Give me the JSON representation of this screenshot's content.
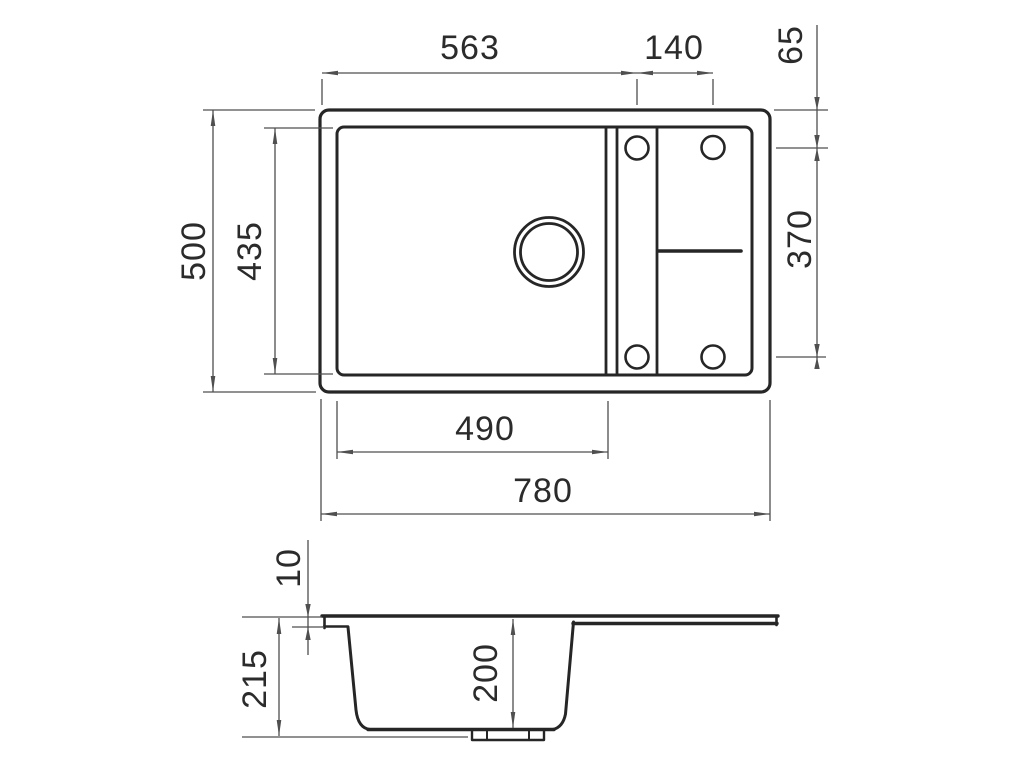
{
  "drawing": {
    "top_view": {
      "width_total": "780",
      "bowl_inner_width": "490",
      "left_edge_to_hole_column": "563",
      "hole_column_spacing": "140",
      "depth_total": "500",
      "inner_depth": "435",
      "top_edge_to_hole_row": "65",
      "hole_row_spacing": "370"
    },
    "section_view": {
      "rim_lip_height": "10",
      "overall_height": "215",
      "bowl_depth": "200"
    }
  },
  "colors": {
    "object_line": "#262626",
    "dimension_line": "#4f4f4f",
    "label_text": "#2b2b2b",
    "background": "#ffffff"
  }
}
